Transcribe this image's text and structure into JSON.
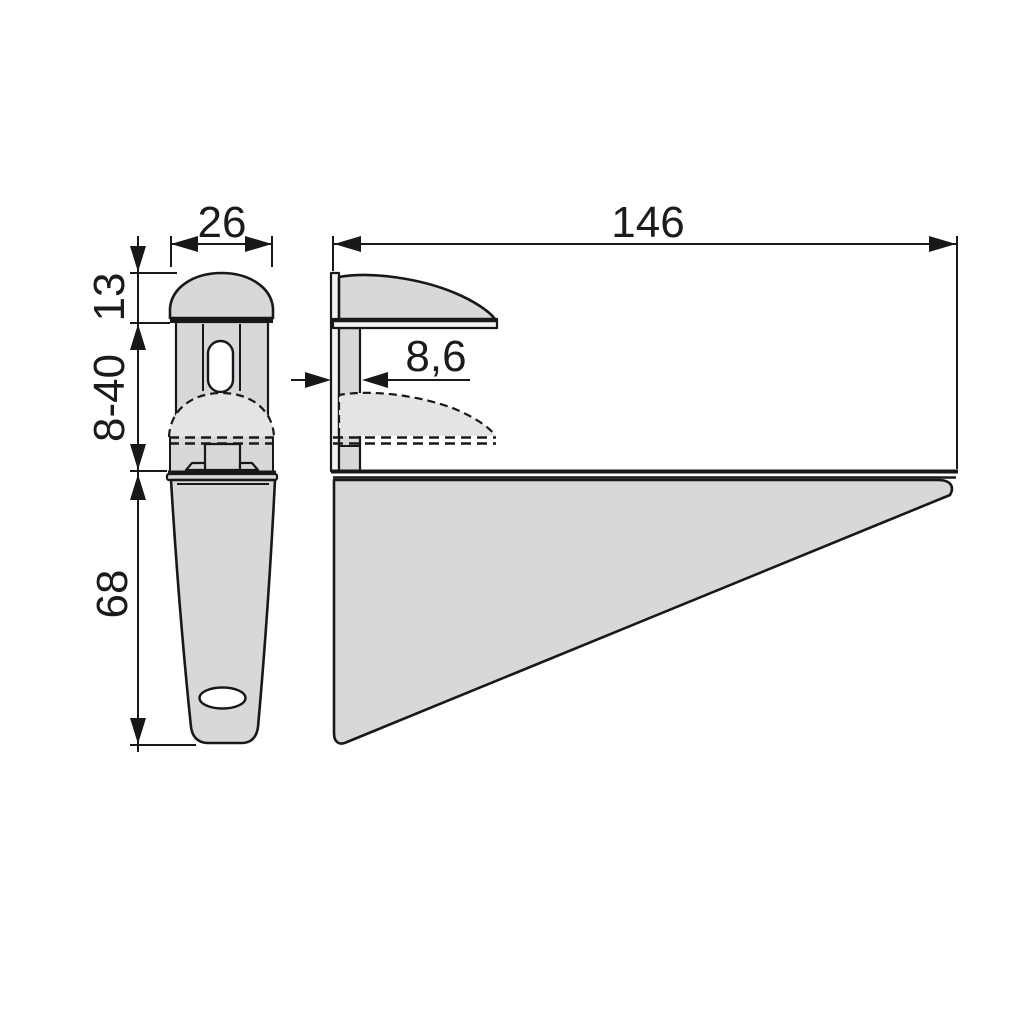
{
  "drawing": {
    "background_color": "#ffffff",
    "line_color": "#17181a",
    "part_fill_color": "#d7d8da",
    "ghost_fill_color": "#e3e4e6",
    "dimensions": {
      "cap_width": "26",
      "depth": "146",
      "cap_height": "13",
      "clamp_range": "8-40",
      "jaw_gap": "8,6",
      "leg_height": "68"
    }
  }
}
